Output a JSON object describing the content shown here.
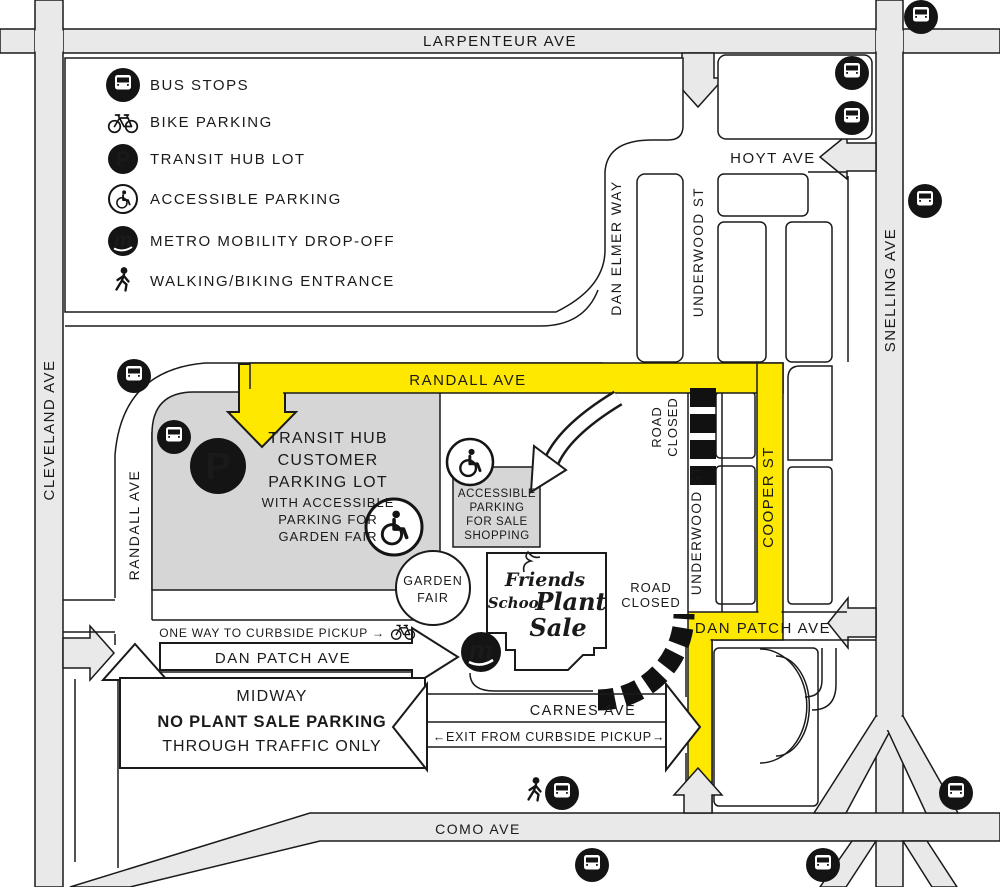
{
  "colors": {
    "route_yellow": "#FFE800",
    "street_gray": "#E9E9E9",
    "lot_gray": "#D6D6D6",
    "ink": "#1A1A1A"
  },
  "legend": {
    "items": [
      {
        "icon": "bus-icon",
        "label": "BUS STOPS"
      },
      {
        "icon": "bike-icon",
        "label": "BIKE PARKING"
      },
      {
        "icon": "transit-hub-parking-icon",
        "label": "TRANSIT HUB LOT"
      },
      {
        "icon": "accessible-parking-icon",
        "label": "ACCESSIBLE PARKING"
      },
      {
        "icon": "metro-mobility-icon",
        "label": "METRO MOBILITY DROP-OFF"
      },
      {
        "icon": "walking-biking-icon",
        "label": "WALKING/BIKING ENTRANCE"
      }
    ]
  },
  "streets": {
    "larpenteur": "LARPENTEUR AVE",
    "cleveland": "CLEVELAND AVE",
    "snelling": "SNELLING AVE",
    "como": "COMO AVE",
    "hoyt": "HOYT AVE",
    "randall": "RANDALL AVE",
    "dan_elmer": "DAN ELMER WAY",
    "underwood": "UNDERWOOD ST",
    "cooper": "COOPER ST",
    "dan_patch": "DAN PATCH AVE",
    "carnes": "CARNES AVE"
  },
  "areas": {
    "transit_hub": {
      "title": [
        "TRANSIT HUB",
        "CUSTOMER",
        "PARKING LOT"
      ],
      "subtitle": [
        "WITH ACCESSIBLE",
        "PARKING FOR",
        "GARDEN FAIR"
      ]
    },
    "accessible_parking": [
      "ACCESSIBLE",
      "PARKING",
      "FOR SALE",
      "SHOPPING"
    ],
    "garden_fair": [
      "GARDEN",
      "FAIR"
    ],
    "midway": {
      "line1": "MIDWAY",
      "line2": "NO PLANT SALE PARKING",
      "line3": "THROUGH TRAFFIC ONLY"
    },
    "plant_sale_logo": {
      "friends": "Friends",
      "school": "School",
      "plant": "Plant",
      "sale": "Sale"
    }
  },
  "notes": {
    "one_way": "ONE WAY TO CURBSIDE PICKUP →",
    "exit": "←EXIT FROM CURBSIDE PICKUP→",
    "road_closed_1": "ROAD",
    "road_closed_2": "CLOSED"
  }
}
